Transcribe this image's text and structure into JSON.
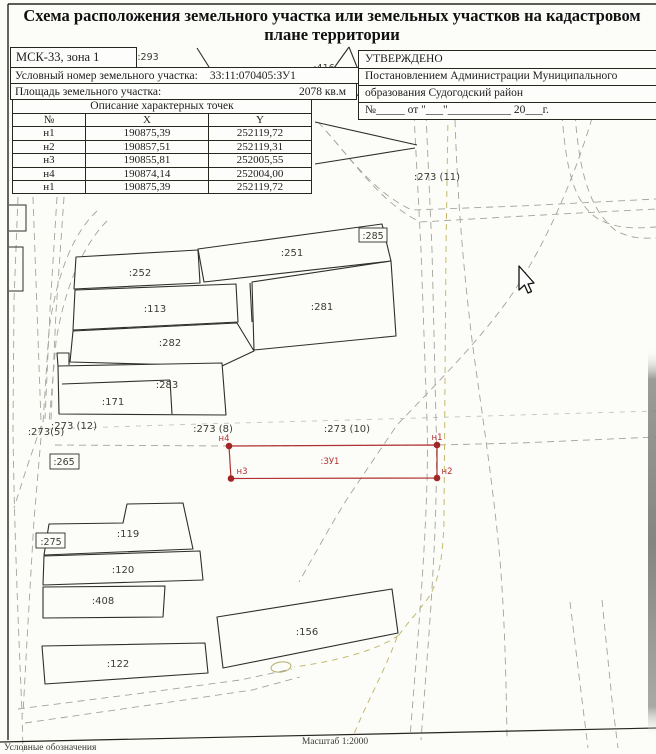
{
  "title": {
    "line1": "Схема расположения земельного участка или земельных участков на кадастровом",
    "line2": "плане территории"
  },
  "header": {
    "zone": "МСК-33, зона 1",
    "cadastral_label": "Условный номер земельного участка:",
    "cadastral_value": "33:11:070405:ЗУ1",
    "area_label": "Площадь земельного участка:",
    "area_value": "2078 кв.м",
    "points_title": "Описание характерных точек",
    "columns": [
      "№",
      "X",
      "Y"
    ],
    "rows": [
      [
        "н1",
        "190875,39",
        "252119,72"
      ],
      [
        "н2",
        "190857,51",
        "252119,31"
      ],
      [
        "н3",
        "190855,81",
        "252005,55"
      ],
      [
        "н4",
        "190874,14",
        "252004,00"
      ],
      [
        "н1",
        "190875,39",
        "252119,72"
      ]
    ]
  },
  "approval": {
    "approved": "УТВЕРЖДЕНО",
    "line1": "Постановлением Администрации  Муниципального",
    "line2": "образования Судогодский район",
    "line3": "№_____ от \"___\"___________ 20___г."
  },
  "map": {
    "labels": {
      "p293": ":293",
      "p416": ":416",
      "p285": ":285",
      "p252": ":252",
      "p251": ":251",
      "p113": ":113",
      "p281": ":281",
      "p282": ":282",
      "p283": ":283",
      "p171": ":171",
      "p273_12": ":273 (12)",
      "p273_5": ":273(5)",
      "p265": ":265",
      "p273_8": ":273 (8)",
      "p273_10": ":273 (10)",
      "p273_11": ":273 (11)",
      "p275": ":275",
      "p119": ":119",
      "p120": ":120",
      "p408": ":408",
      "p122": ":122",
      "p156": ":156"
    },
    "subject": {
      "label": ":ЗУ1",
      "n1": "н1",
      "n2": "н2",
      "n3": "н3",
      "n4": "н4",
      "color": "#b03131"
    },
    "road_color": "#a4a49c",
    "path_color": "#c4ba6d"
  },
  "footer": {
    "scale": "Масштаб 1:2000",
    "legend": "Условные обозначения"
  }
}
